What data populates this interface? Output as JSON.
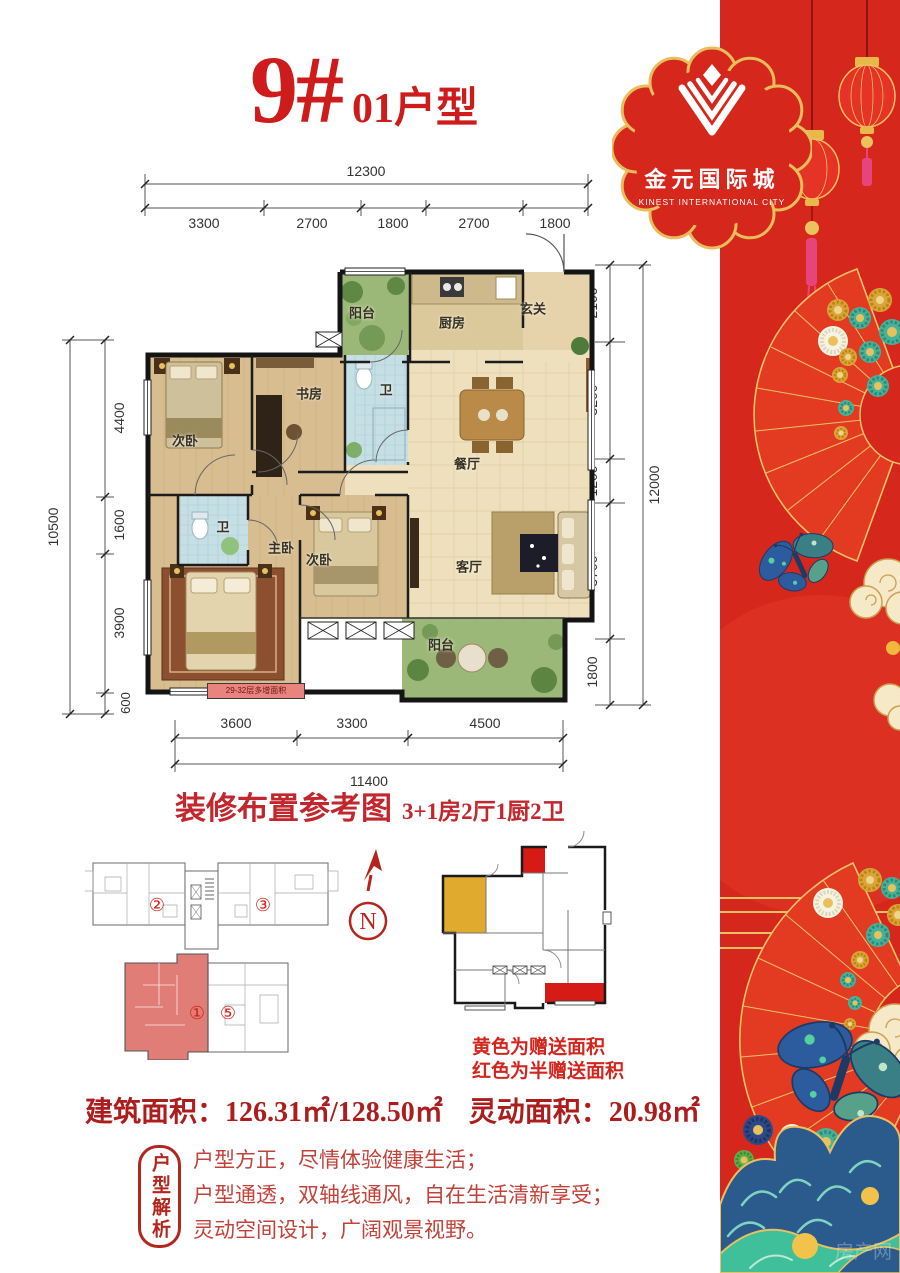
{
  "title": {
    "number": "9#",
    "type": "01户型"
  },
  "logo": {
    "cn": "金元国际城",
    "en": "KINEST INTERNATIONAL CITY"
  },
  "dims": {
    "top": {
      "total": "12300",
      "segs": [
        "3300",
        "2700",
        "1800",
        "2700",
        "1800"
      ]
    },
    "left": {
      "total": "10500",
      "segs": [
        "4400",
        "1600",
        "3900",
        "600"
      ]
    },
    "right": {
      "total": "12000",
      "segs": [
        "2100",
        "3200",
        "1200",
        "3700",
        "1800"
      ]
    },
    "bottom": {
      "total": "11400",
      "segs": [
        "3600",
        "3300",
        "4500"
      ]
    }
  },
  "plan": {
    "rooms": {
      "balcony_top": "阳台",
      "kitchen": "厨房",
      "entry": "玄关",
      "bath_top": "卫",
      "study": "书房",
      "bedroom_nw": "次卧",
      "dining": "餐厅",
      "bath_mid": "卫",
      "master": "主卧",
      "bedroom_s": "次卧",
      "living": "客厅",
      "balcony_bottom": "阳台"
    },
    "strip_note": "29-32层多增面积"
  },
  "caption": {
    "title": "装修布置参考图",
    "layout": "3+1房2厅1厨2卫"
  },
  "keyplan": {
    "unit2": "②",
    "unit3": "③",
    "unit1": "①",
    "unit5": "⑤",
    "compass": "N"
  },
  "gift": {
    "legend1": "黄色为赠送面积",
    "legend2": "红色为半赠送面积"
  },
  "areas": {
    "building_label": "建筑面积：",
    "building_value": "126.31㎡/128.50㎡",
    "flex_label": "灵动面积：",
    "flex_value": "20.98㎡"
  },
  "analysis": {
    "badge": "户型解析",
    "line1": "户型方正，尽情体验健康生活；",
    "line2": "户型通透，双轴线通风，自在生活清新享受；",
    "line3": "灵动空间设计，广阔观景视野。"
  },
  "watermark": "房产网",
  "colors": {
    "accent_red": "#ce1c1c",
    "panel_red": "#d5271b",
    "gold": "#e9c163",
    "gift_yellow": "#dfaa2e",
    "gift_red": "#d61a15",
    "highlight_unit": "#e0837c"
  }
}
